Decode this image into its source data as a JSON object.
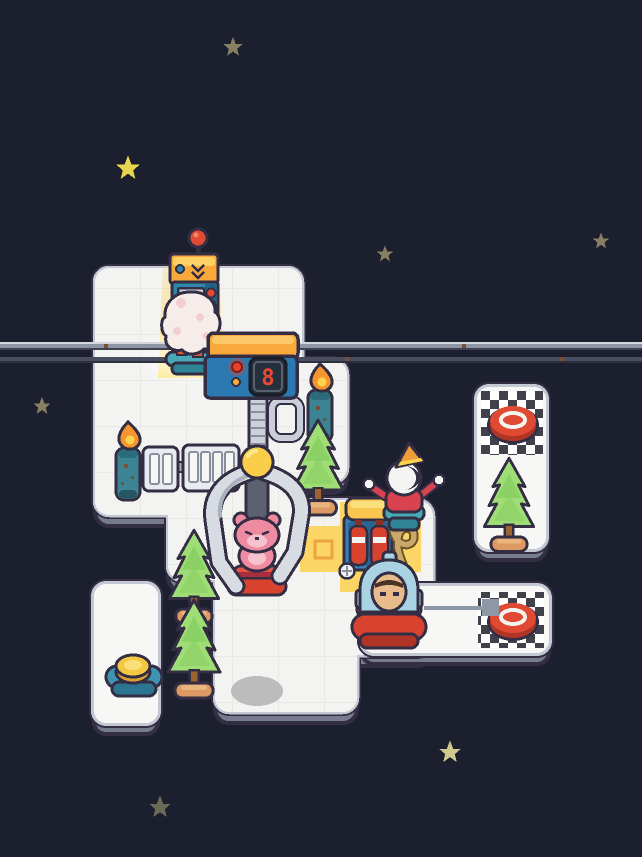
{
  "scene": {
    "title": "space-workshop-puzzle-level",
    "background_color": "#1c1f2e"
  },
  "console": {
    "display_value": "8"
  },
  "colors": {
    "sky": "#1c1f2e",
    "platform_white": "#f3f3f1",
    "platform_border": "#c3c8d2",
    "outline_dark": "#332e44",
    "beam_yellow": "#fbd566",
    "tile_yellow": "#fbd566",
    "tile_marker_orange": "#eba43e",
    "button_red": "#e04a33",
    "machine_teal": "#2e86a8",
    "console_blue": "#2b79b0",
    "cap_orange": "#f9a93c",
    "claw_metal": "#d7dbe2",
    "bear_pink": "#ef8ba0",
    "base_red": "#d8432f",
    "tree_green": "#9fdd77",
    "pot_tan": "#dc9a62",
    "character_blue": "#a9d2e2",
    "skin_tan": "#e8bb8d",
    "ghost_white": "#f4f4f2",
    "pedestal_teal": "#49a8b5",
    "coin_yellow": "#f5c844",
    "star_bright": "#e8d44d",
    "star_dim": "#867f62",
    "star_pale": "#cfc98f",
    "star_faint": "#6b6a58",
    "digit_red": "#e84a33",
    "arrow_gray": "#8e97a6"
  },
  "objects": {
    "top_machine": "dispenser machine with red antenna ball",
    "fluff_creature": "white fluffy creature on teal base",
    "claw_console": "claw control console with digital display",
    "claw": "metal claw grabber",
    "bear": "pink bear on red base",
    "vending_machine": "tank dispenser with two red canisters",
    "coil_hose": "tan coiled hose",
    "ghost": "white ghost in red sweater with party hat",
    "player_character": "blue hooded character on red base",
    "move_arrow": "movement direction arrow",
    "goal_pad_top": "checkered goal pad with red button",
    "goal_pad_bottom": "checkered goal pad with red button",
    "coin_pad": "teal pad with yellow coin",
    "torch": "teal pillar torch with flame",
    "rack": "metal slatted rack",
    "tree": "pine tree in pot",
    "cable": "horizontal double cable",
    "star": "background star",
    "shadow_stain": "gray floor stain"
  }
}
